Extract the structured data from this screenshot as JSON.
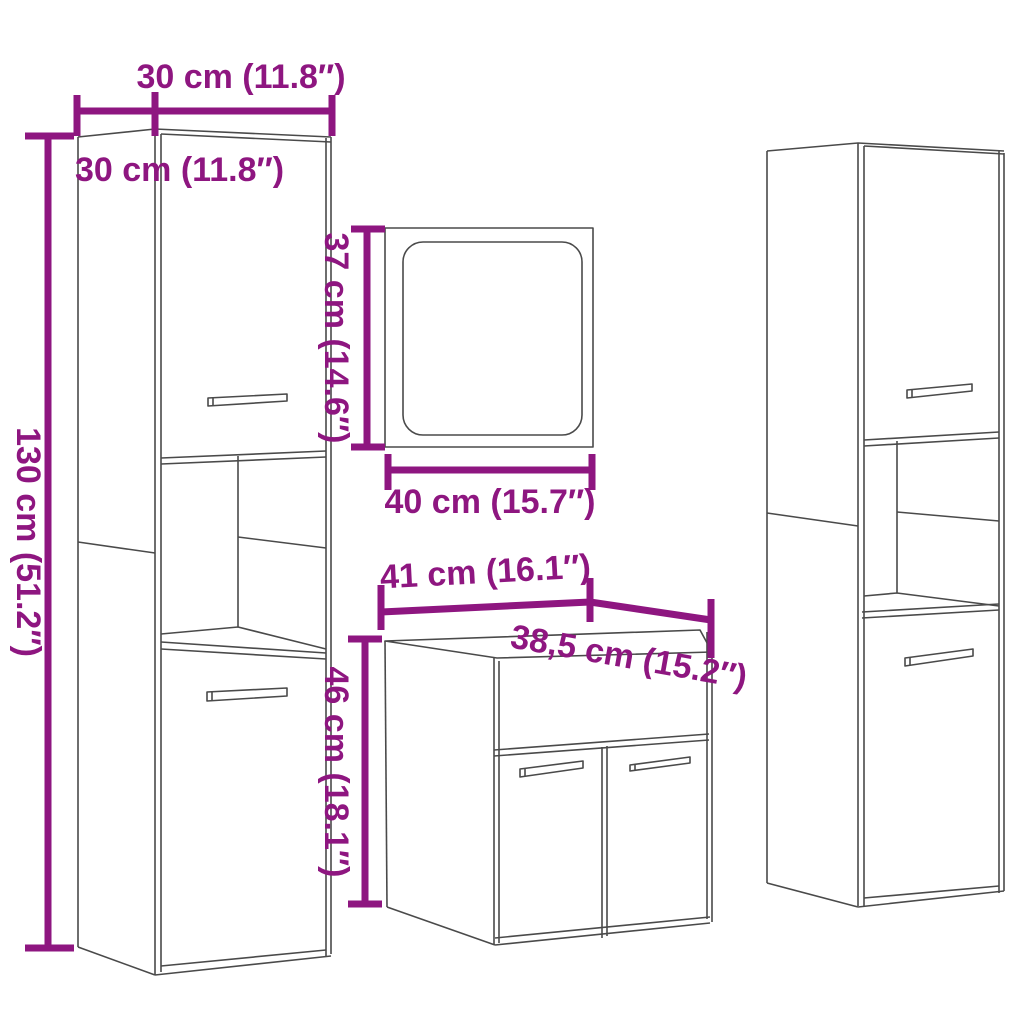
{
  "diagram": {
    "type": "product-dimension-diagram",
    "subject": "bathroom furniture set (two tall cabinets, mirror, sink cabinet)",
    "colors": {
      "dimension": "#8E1680",
      "outline": "#4a4a4a",
      "background": "#ffffff"
    },
    "labels": {
      "tall_cabinet_width": "30 cm (11.8″)",
      "tall_cabinet_depth": "30 cm (11.8″)",
      "tall_cabinet_height": "130 cm (51.2″)",
      "mirror_height": "37 cm (14.6″)",
      "mirror_width": "40 cm (15.7″)",
      "sink_cabinet_width": "41 cm (16.1″)",
      "sink_cabinet_depth": "38,5 cm (15.2″)",
      "sink_cabinet_height": "46 cm (18.1″)"
    }
  }
}
